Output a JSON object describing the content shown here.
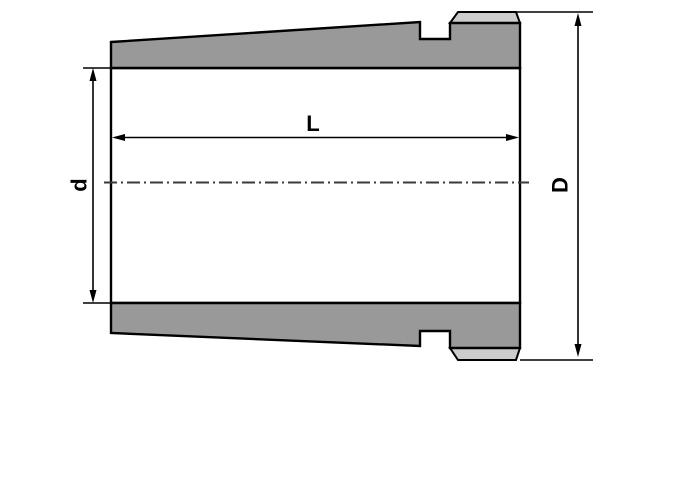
{
  "drawing": {
    "name": "Tapered adapter sleeve cross-section",
    "labels": {
      "length": "L",
      "bore_diameter": "d",
      "outer_diameter": "D"
    },
    "colors": {
      "part_fill": "#999999",
      "chamfer_fill": "#cccccc",
      "line": "#000000",
      "centerline": "#3a3a3a",
      "background": "#ffffff"
    }
  }
}
